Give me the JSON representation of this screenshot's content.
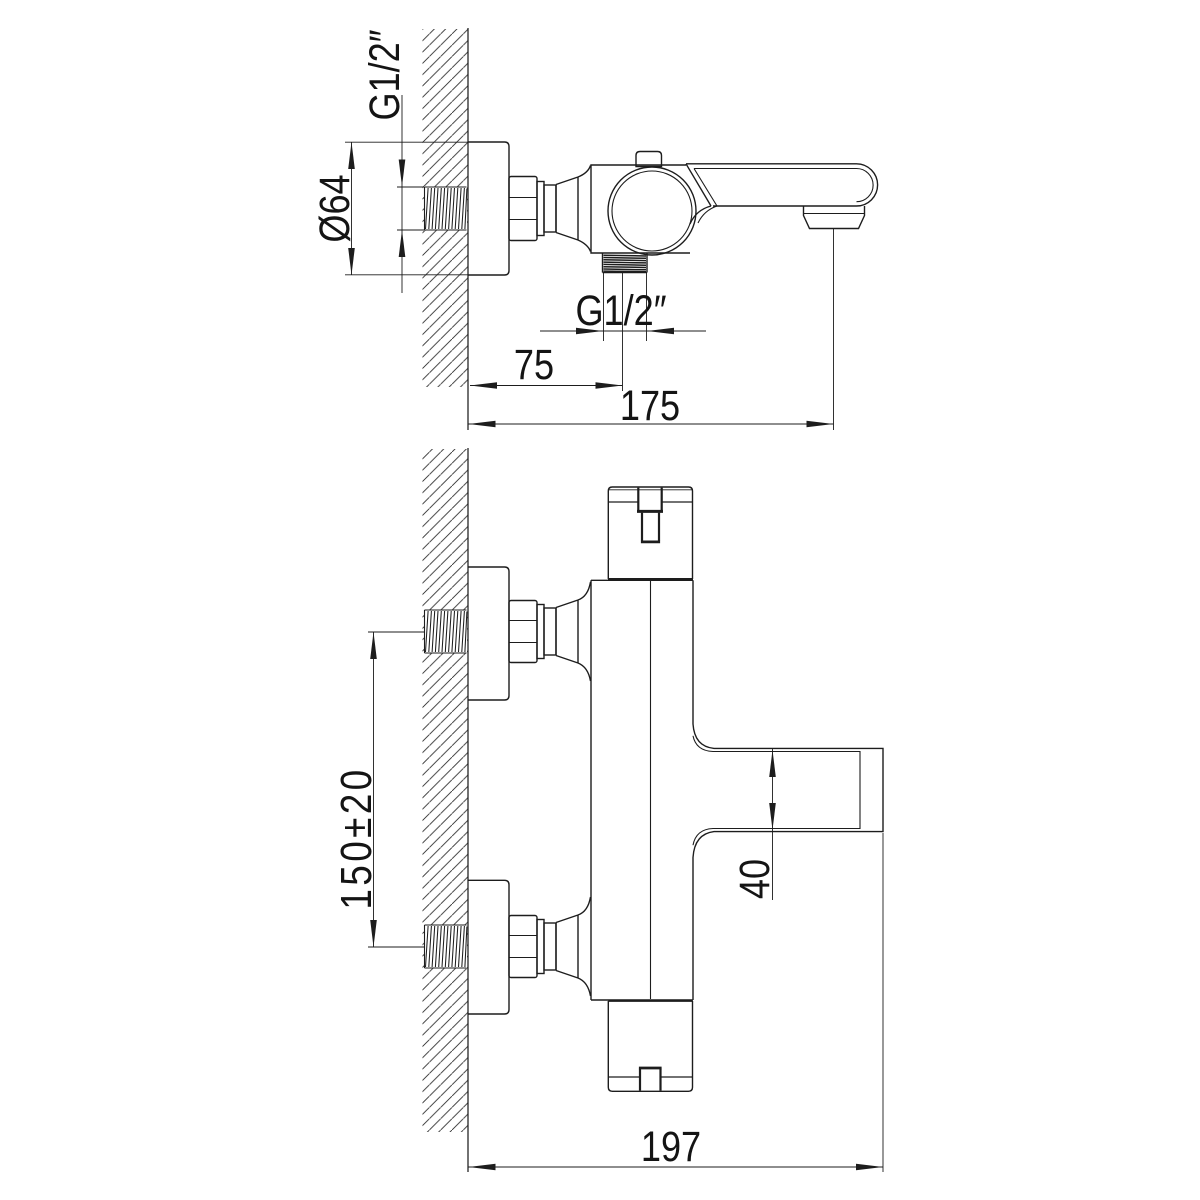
{
  "page": {
    "background": "#ffffff",
    "line_color": "#1d1d1d",
    "content_type": "faucet installation dimension drawing"
  },
  "views": {
    "side_view": {
      "labels": {
        "wall_thread": "G1/2″",
        "flange_diameter": "Ø64",
        "outlet_thread": "G1/2″",
        "outlet_offset": "75",
        "spout_reach": "175"
      }
    },
    "front_view": {
      "labels": {
        "inlet_spacing": "150±20",
        "spout_width": "40",
        "overall_depth": "197"
      }
    }
  }
}
